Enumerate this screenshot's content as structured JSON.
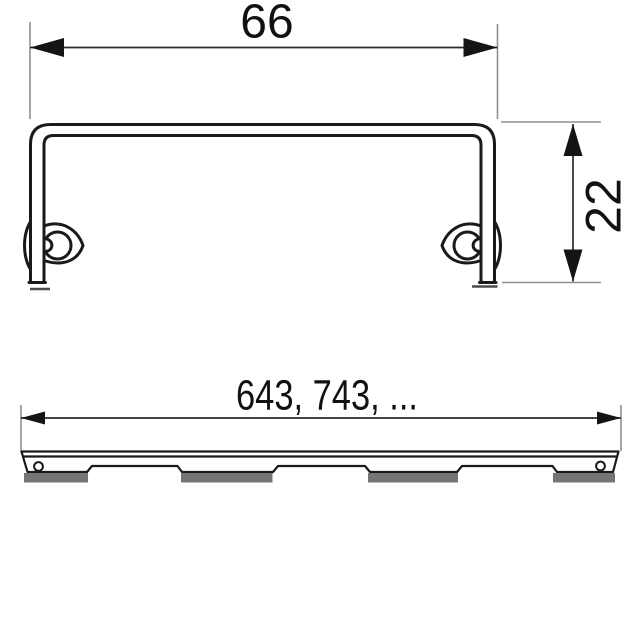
{
  "drawing": {
    "top_section": {
      "description": "cross-section of channel grate frame with fastening clips",
      "width_label": "66",
      "height_label": "22"
    },
    "side_section": {
      "description": "side view of grate body with support feet",
      "length_label": "643, 743, ..."
    },
    "colors": {
      "outline": "#1a1a1a",
      "dimension_line": "#2a2a2a",
      "extension_line": "#8f8f8f",
      "foot_fill": "#757575",
      "datum_line": "#4d4d4d",
      "background": "#ffffff"
    }
  }
}
